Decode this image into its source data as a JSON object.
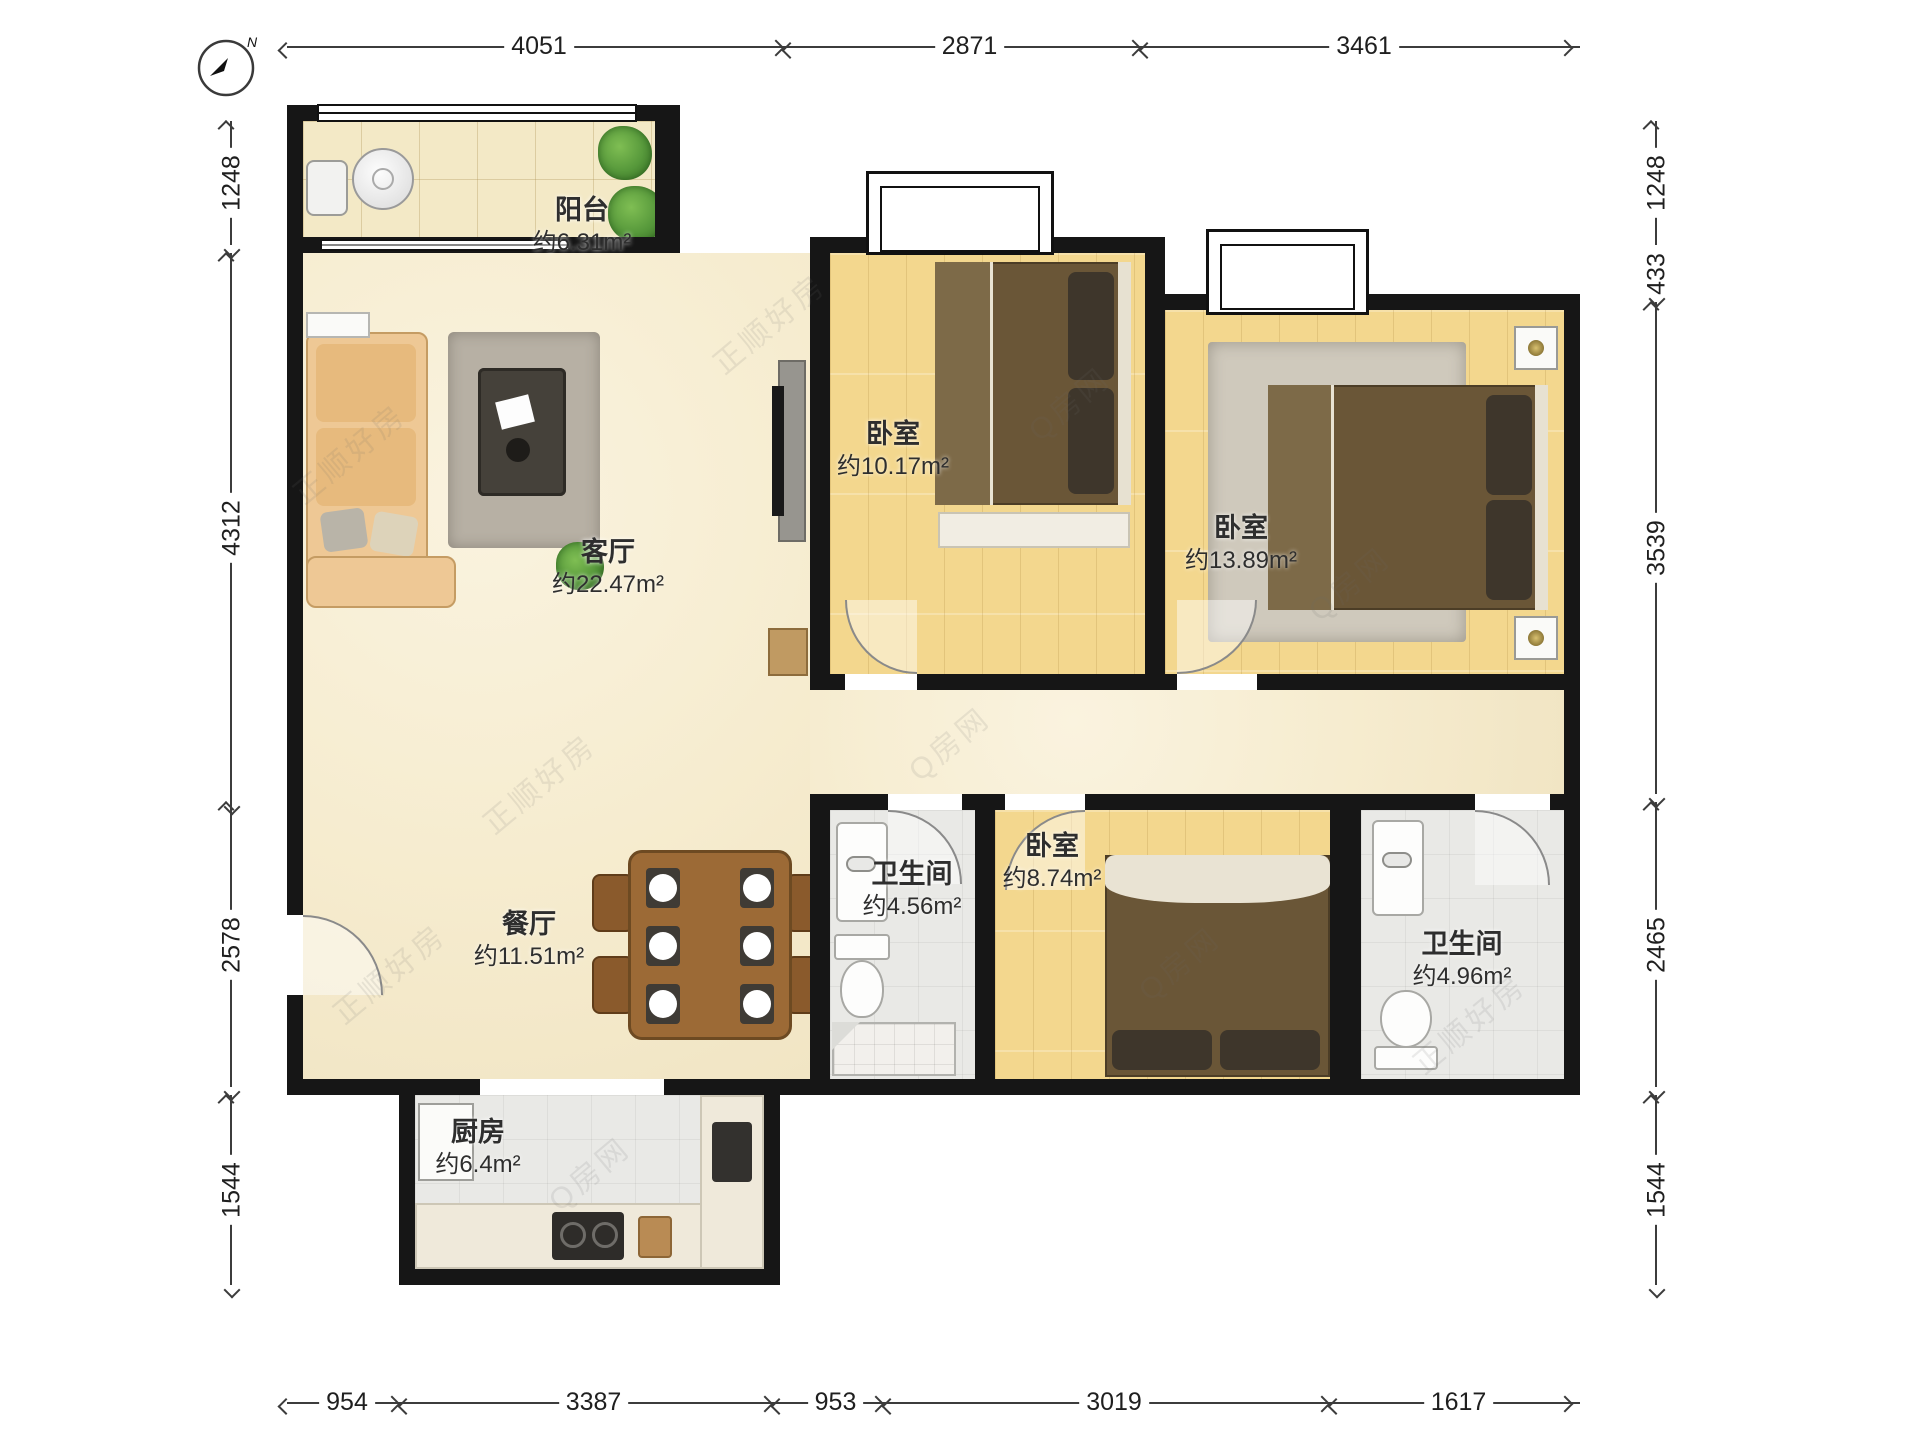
{
  "compass": {
    "north_label": "N"
  },
  "rooms": {
    "balcony": {
      "name": "阳台",
      "area": "约6.31m²"
    },
    "living": {
      "name": "客厅",
      "area": "约22.47m²"
    },
    "bedroom1": {
      "name": "卧室",
      "area": "约10.17m²"
    },
    "bedroom2": {
      "name": "卧室",
      "area": "约13.89m²"
    },
    "bedroom3": {
      "name": "卧室",
      "area": "约8.74m²"
    },
    "bath1": {
      "name": "卫生间",
      "area": "约4.56m²"
    },
    "bath2": {
      "name": "卫生间",
      "area": "约4.96m²"
    },
    "dining": {
      "name": "餐厅",
      "area": "约11.51m²"
    },
    "kitchen": {
      "name": "厨房",
      "area": "约6.4m²"
    }
  },
  "dimensions": {
    "top": [
      "4051",
      "2871",
      "3461"
    ],
    "bottom": [
      "954",
      "3387",
      "953",
      "3019",
      "1617"
    ],
    "left": [
      "1248",
      "4312",
      "2578",
      "1544"
    ],
    "right": [
      "1248",
      "433",
      "3539",
      "2465",
      "1544"
    ]
  },
  "watermarks": [
    "正顺好房",
    "Q房网"
  ],
  "colors": {
    "wall": "#161616",
    "wood_floor": "#f3d78e",
    "marble_floor": "#f6eccf",
    "tile_floor": "#e9e9e6",
    "bed": "#6a5637",
    "dining_table": "#9c6a36"
  }
}
